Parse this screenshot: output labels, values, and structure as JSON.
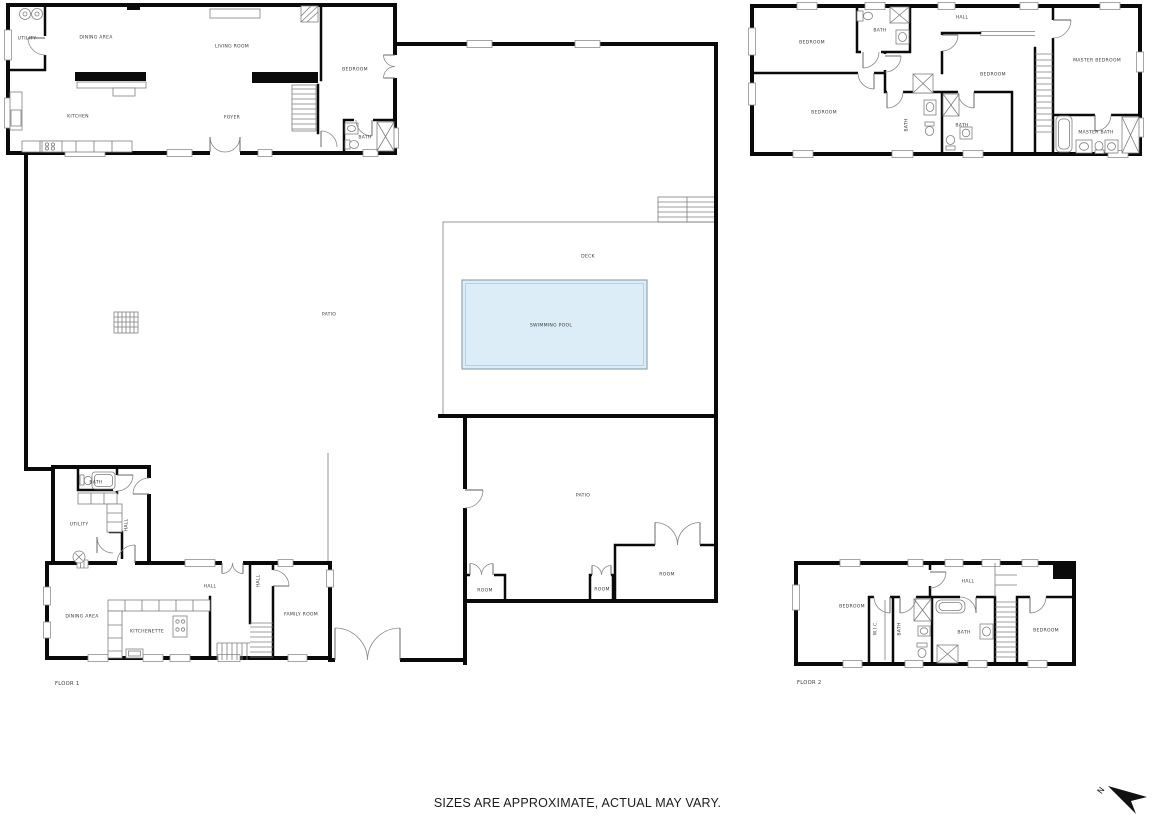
{
  "meta": {
    "title": "Residential floor plan",
    "disclaimer": "SIZES ARE APPROXIMATE, ACTUAL MAY VARY.",
    "north_label": "N"
  },
  "colors": {
    "background": "#ffffff",
    "wall": "#0a0a0a",
    "thin_line": "#8f8f8f",
    "pool_fill": "#ddedf8",
    "pool_border": "#8fa6b4",
    "label_text": "#3a3a3a",
    "footer_text": "#1c1c1c"
  },
  "floor_labels": [
    {
      "text": "FLOOR 1",
      "x": 55,
      "y": 684
    },
    {
      "text": "FLOOR 2",
      "x": 797,
      "y": 683
    }
  ],
  "room_labels": [
    {
      "text": "UTILITY",
      "x": 27,
      "y": 39,
      "area": "floor-1"
    },
    {
      "text": "DINING AREA",
      "x": 96,
      "y": 38,
      "area": "floor-1"
    },
    {
      "text": "LIVING ROOM",
      "x": 232,
      "y": 47,
      "area": "floor-1"
    },
    {
      "text": "BEDROOM",
      "x": 355,
      "y": 70,
      "area": "floor-1"
    },
    {
      "text": "KITCHEN",
      "x": 78,
      "y": 117,
      "area": "floor-1"
    },
    {
      "text": "FOYER",
      "x": 232,
      "y": 118,
      "area": "floor-1"
    },
    {
      "text": "BATH",
      "x": 365,
      "y": 138,
      "area": "floor-1"
    },
    {
      "text": "BEDROOM",
      "x": 812,
      "y": 43,
      "area": "floor-2"
    },
    {
      "text": "BATH",
      "x": 880,
      "y": 31,
      "area": "floor-2"
    },
    {
      "text": "HALL",
      "x": 962,
      "y": 18,
      "area": "floor-2"
    },
    {
      "text": "BEDROOM",
      "x": 824,
      "y": 113,
      "area": "floor-2"
    },
    {
      "text": "BATH",
      "x": 907,
      "y": 125,
      "rot": true,
      "area": "floor-2"
    },
    {
      "text": "BATH",
      "x": 962,
      "y": 126,
      "area": "floor-2"
    },
    {
      "text": "BEDROOM",
      "x": 993,
      "y": 75,
      "area": "floor-2"
    },
    {
      "text": "MASTER BEDROOM",
      "x": 1097,
      "y": 61,
      "area": "floor-2"
    },
    {
      "text": "MASTER BATH",
      "x": 1096,
      "y": 133,
      "area": "floor-2"
    },
    {
      "text": "DECK",
      "x": 588,
      "y": 257,
      "area": "outdoor"
    },
    {
      "text": "SWIMMING POOL",
      "x": 551,
      "y": 326,
      "area": "outdoor"
    },
    {
      "text": "PATIO",
      "x": 329,
      "y": 315,
      "area": "outdoor"
    },
    {
      "text": "PATIO",
      "x": 583,
      "y": 496,
      "area": "outdoor"
    },
    {
      "text": "BATH",
      "x": 96,
      "y": 483,
      "area": "floor-1"
    },
    {
      "text": "UTILITY",
      "x": 79,
      "y": 525,
      "area": "floor-1"
    },
    {
      "text": "HALL",
      "x": 127,
      "y": 525,
      "rot": true,
      "area": "floor-1"
    },
    {
      "text": "DINING AREA",
      "x": 82,
      "y": 617,
      "area": "floor-1"
    },
    {
      "text": "KITCHENETTE",
      "x": 147,
      "y": 632,
      "area": "floor-1"
    },
    {
      "text": "HALL",
      "x": 210,
      "y": 587,
      "area": "floor-1"
    },
    {
      "text": "HALL",
      "x": 259,
      "y": 581,
      "rot": true,
      "area": "floor-1"
    },
    {
      "text": "FAMILY ROOM",
      "x": 301,
      "y": 615,
      "area": "floor-1"
    },
    {
      "text": "ROOM",
      "x": 485,
      "y": 591,
      "area": "floor-1"
    },
    {
      "text": "ROOM",
      "x": 602,
      "y": 590,
      "area": "floor-1"
    },
    {
      "text": "ROOM",
      "x": 667,
      "y": 575,
      "area": "floor-1"
    },
    {
      "text": "BEDROOM",
      "x": 852,
      "y": 607,
      "area": "floor-2"
    },
    {
      "text": "W.I.C.",
      "x": 876,
      "y": 628,
      "rot": true,
      "area": "floor-2"
    },
    {
      "text": "BATH",
      "x": 900,
      "y": 629,
      "rot": true,
      "area": "floor-2"
    },
    {
      "text": "HALL",
      "x": 968,
      "y": 582,
      "area": "floor-2"
    },
    {
      "text": "BATH",
      "x": 964,
      "y": 633,
      "area": "floor-2"
    },
    {
      "text": "BEDROOM",
      "x": 1046,
      "y": 631,
      "area": "floor-2"
    }
  ]
}
